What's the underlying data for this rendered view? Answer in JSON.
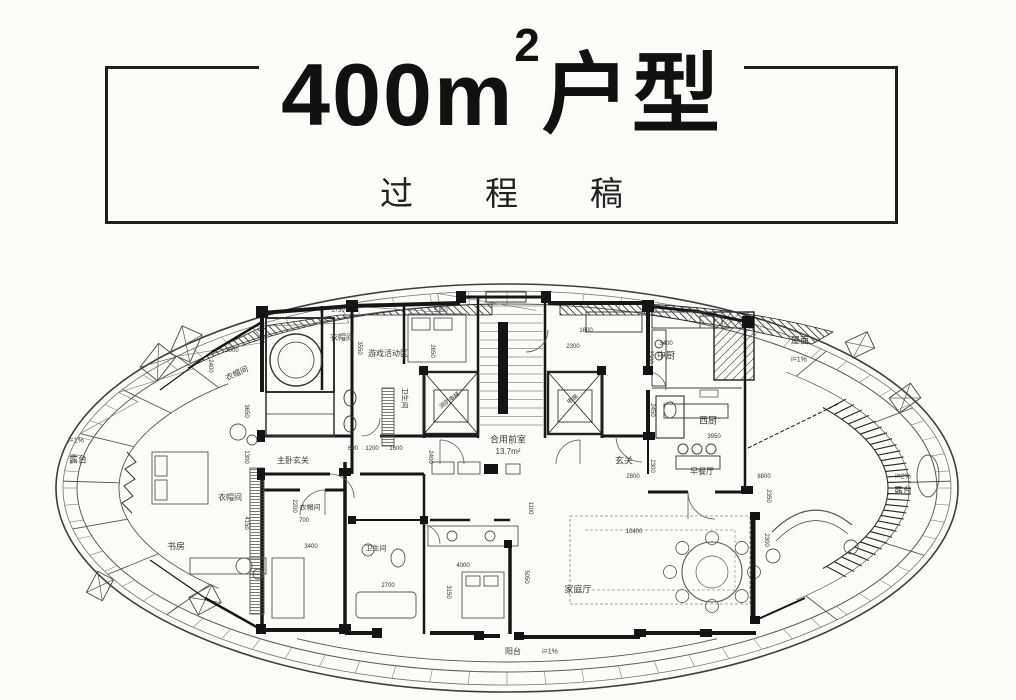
{
  "title": {
    "main": "400m",
    "sup": "2",
    "suffix": "户型",
    "subtitle": "过程稿"
  },
  "plan": {
    "labels": [
      {
        "t": "露台",
        "x": 78,
        "y": 460,
        "fs": 9
      },
      {
        "t": "i=1%",
        "x": 76,
        "y": 441,
        "fs": 7
      },
      {
        "t": "书房",
        "x": 176,
        "y": 547,
        "fs": 9
      },
      {
        "t": "衣帽间",
        "x": 230,
        "y": 498,
        "fs": 8
      },
      {
        "t": "衣帽间",
        "x": 237,
        "y": 374,
        "fs": 8,
        "r": -25
      },
      {
        "t": "主卧玄关",
        "x": 293,
        "y": 461,
        "fs": 8
      },
      {
        "t": "衣帽间",
        "x": 310,
        "y": 508,
        "fs": 7
      },
      {
        "t": "卫生间",
        "x": 376,
        "y": 549,
        "fs": 7
      },
      {
        "t": "衣帽间",
        "x": 342,
        "y": 338,
        "fs": 8
      },
      {
        "t": "游戏活动区",
        "x": 388,
        "y": 354,
        "fs": 8
      },
      {
        "t": "卫生间",
        "x": 404,
        "y": 398,
        "fs": 7,
        "r": 90
      },
      {
        "t": "消防电梯",
        "x": 450,
        "y": 401,
        "fs": 6,
        "r": -36
      },
      {
        "t": "电梯",
        "x": 573,
        "y": 400,
        "fs": 6,
        "r": -36
      },
      {
        "t": "合用前室",
        "x": 508,
        "y": 440,
        "fs": 9
      },
      {
        "t": "13.7m²",
        "x": 508,
        "y": 452,
        "fs": 8
      },
      {
        "t": "玄关",
        "x": 624,
        "y": 461,
        "fs": 9
      },
      {
        "t": "中厨",
        "x": 666,
        "y": 356,
        "fs": 9
      },
      {
        "t": "西厨",
        "x": 708,
        "y": 421,
        "fs": 9
      },
      {
        "t": "早餐厅",
        "x": 702,
        "y": 472,
        "fs": 8
      },
      {
        "t": "家庭厅",
        "x": 578,
        "y": 590,
        "fs": 9
      },
      {
        "t": "屋面",
        "x": 800,
        "y": 341,
        "fs": 9
      },
      {
        "t": "i=1%",
        "x": 799,
        "y": 360,
        "fs": 7
      },
      {
        "t": "i=2%",
        "x": 903,
        "y": 477,
        "fs": 7
      },
      {
        "t": "露台",
        "x": 903,
        "y": 491,
        "fs": 9
      },
      {
        "t": "阳台",
        "x": 513,
        "y": 652,
        "fs": 8
      },
      {
        "t": "i=1%",
        "x": 550,
        "y": 652,
        "fs": 7
      }
    ],
    "dims": [
      {
        "t": "3000",
        "x": 232,
        "y": 351
      },
      {
        "t": "2400",
        "x": 210,
        "y": 366,
        "r": 90
      },
      {
        "t": "3650",
        "x": 246,
        "y": 411,
        "r": 90
      },
      {
        "t": "1300",
        "x": 246,
        "y": 457,
        "r": 90
      },
      {
        "t": "4150",
        "x": 246,
        "y": 523,
        "r": 90
      },
      {
        "t": "1750",
        "x": 338,
        "y": 311
      },
      {
        "t": "3550",
        "x": 359,
        "y": 348,
        "r": 90
      },
      {
        "t": "5150",
        "x": 441,
        "y": 311
      },
      {
        "t": "2650",
        "x": 432,
        "y": 351,
        "r": 90
      },
      {
        "t": "600",
        "x": 353,
        "y": 449
      },
      {
        "t": "1200",
        "x": 372,
        "y": 449
      },
      {
        "t": "1600",
        "x": 396,
        "y": 449
      },
      {
        "t": "2400",
        "x": 430,
        "y": 457,
        "r": 90
      },
      {
        "t": "1600",
        "x": 586,
        "y": 331
      },
      {
        "t": "2300",
        "x": 573,
        "y": 347
      },
      {
        "t": "3400",
        "x": 666,
        "y": 344
      },
      {
        "t": "2500",
        "x": 650,
        "y": 357,
        "r": 90
      },
      {
        "t": "2450",
        "x": 652,
        "y": 410,
        "r": 90
      },
      {
        "t": "3950",
        "x": 714,
        "y": 437
      },
      {
        "t": "2800",
        "x": 633,
        "y": 477
      },
      {
        "t": "2300",
        "x": 652,
        "y": 466,
        "r": 90
      },
      {
        "t": "8800",
        "x": 764,
        "y": 477
      },
      {
        "t": "2350",
        "x": 768,
        "y": 496,
        "r": 90
      },
      {
        "t": "2300",
        "x": 766,
        "y": 540,
        "r": 90
      },
      {
        "t": "10400",
        "x": 634,
        "y": 532
      },
      {
        "t": "1100",
        "x": 530,
        "y": 508,
        "r": 90
      },
      {
        "t": "5050",
        "x": 526,
        "y": 577,
        "r": 90
      },
      {
        "t": "4000",
        "x": 463,
        "y": 566
      },
      {
        "t": "3150",
        "x": 448,
        "y": 592,
        "r": 90
      },
      {
        "t": "2700",
        "x": 388,
        "y": 586
      },
      {
        "t": "2200",
        "x": 294,
        "y": 506,
        "r": 90
      },
      {
        "t": "700",
        "x": 304,
        "y": 521
      },
      {
        "t": "3400",
        "x": 311,
        "y": 547
      }
    ]
  },
  "colors": {
    "ink": "#1a1a1a",
    "wall": "#161616",
    "thin": "#555",
    "accent": "#2a2a2a"
  }
}
